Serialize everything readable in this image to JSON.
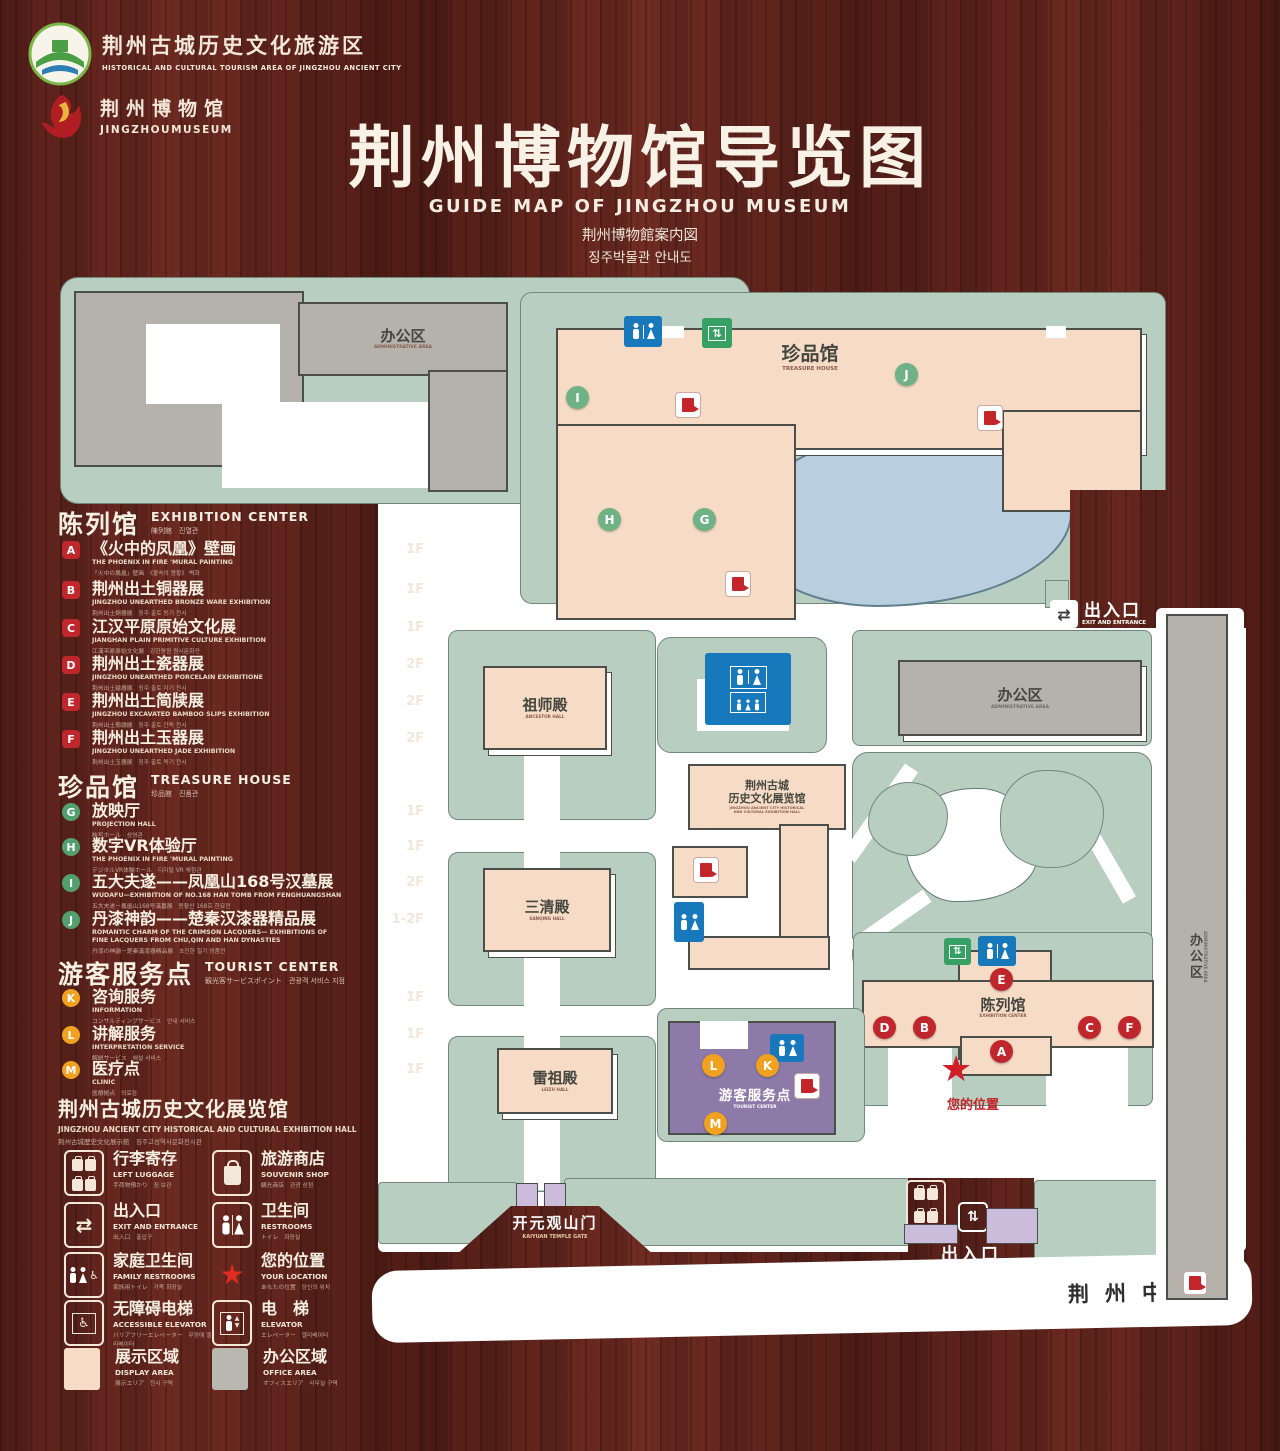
{
  "colors": {
    "wood": "#5b211a",
    "lawn": "#b7cec0",
    "building_gray": "#b4b2aa",
    "building_peach": "#f6dcc6",
    "pond": "#b9cede",
    "purple": "#8d7aa8",
    "purple_light": "#cbbcdc",
    "icon_blue": "#1878bc",
    "icon_green": "#36a065",
    "marker_red": "#c0272d",
    "marker_green": "#6fb286",
    "marker_yellow": "#f0a11f",
    "star_red": "#d01f26"
  },
  "header": {
    "logo_area": {
      "cn": "荆州古城历史文化旅游区",
      "en": "HISTORICAL AND CULTURAL TOURISM AREA OF JINGZHOU ANCIENT CITY"
    },
    "logo_museum": {
      "cn": "荆州博物馆",
      "en": "JINGZHOUMUSEUM"
    },
    "title": "荆州博物馆导览图",
    "subtitle_en": "GUIDE MAP OF JINGZHOU MUSEUM",
    "subtitle_ja": "荆州博物館案内図",
    "subtitle_ko": "징주박물관 안내도"
  },
  "legend": {
    "sections": [
      {
        "cn": "陈列馆",
        "en": "EXHIBITION CENTER",
        "sub": "陳列館　진열관",
        "items": [
          {
            "letter": "A",
            "cn": "《火中的凤凰》壁画",
            "en": "THE PHOENIX IN FIRE 'MURAL PAINTING",
            "sub": "「火中の鳳凰」壁画　《불속의 봉황》 벽화",
            "floor": "1F"
          },
          {
            "letter": "B",
            "cn": "荆州出土铜器展",
            "en": "JINGZHOU UNEARTHED BRONZE WARE EXHIBITION",
            "sub": "荆州出土銅器展　징주 출토 동기 전시",
            "floor": "1F"
          },
          {
            "letter": "C",
            "cn": "江汉平原原始文化展",
            "en": "JIANGHAN PLAIN PRIMITIVE CULTURE EXHIBITION",
            "sub": "江漢平原原始文化展　강한평원 원시문화전",
            "floor": "1F"
          },
          {
            "letter": "D",
            "cn": "荆州出土瓷器展",
            "en": "JINGZHOU UNEARTHED PORCELAIN EXHIBITIONE",
            "sub": "荆州出土磁器展　징주 출토 자기 전시",
            "floor": "2F"
          },
          {
            "letter": "E",
            "cn": "荆州出土简牍展",
            "en": "JINGZHOU EXCAVATED BAMBOO SLIPS EXHIBITION",
            "sub": "荆州出土簡牘展　징주 출토 간독 전시",
            "floor": "2F"
          },
          {
            "letter": "F",
            "cn": "荆州出土玉器展",
            "en": "JINGZHOU UNEARTHED JADE EXHIBITION",
            "sub": "荆州出土玉器展　징주 출토 옥기 전시",
            "floor": "2F"
          }
        ]
      },
      {
        "cn": "珍品馆",
        "en": "TREASURE HOUSE",
        "sub": "珍品館　진품관",
        "items": [
          {
            "letter": "G",
            "cn": "放映厅",
            "en": "PROJECTION HALL",
            "sub": "映写ホール　상영관",
            "floor": "1F"
          },
          {
            "letter": "H",
            "cn": "数字VR体验厅",
            "en": "THE PHOENIX IN FIRE 'MURAL PAINTING",
            "sub": "デジタルVR体験ホール　디지털 VR 체험관",
            "floor": "1F"
          },
          {
            "letter": "I",
            "cn": "五大夫遂——凤凰山168号汉墓展",
            "en": "WUDAFU—EXHIBITION OF NO.168 HAN TOMB FROM FENGHUANGSHAN",
            "sub": "五大夫遂－鳳凰山168号漢墓展　봉황산 168호 한묘전",
            "floor": "2F"
          },
          {
            "letter": "J",
            "cn": "丹漆神韵——楚秦汉漆器精品展",
            "en": "ROMANTIC CHARM OF THE CRIMSON LACQUERS— EXHIBITIONS OF FINE LACQUERS FROM CHU,QIN AND HAN DYNASTIES",
            "sub": "丹漆の神韻－楚秦漢漆器精品展　초진한 칠기 정품전",
            "floor": "1-2F"
          }
        ]
      },
      {
        "cn": "游客服务点",
        "en": "TOURIST CENTER",
        "sub": "観光客サービスポイント　관광객 서비스 지점",
        "items": [
          {
            "letter": "K",
            "cn": "咨询服务",
            "en": "INFORMATION",
            "sub": "コンサルティングサービス　안내 서비스",
            "floor": "1F"
          },
          {
            "letter": "L",
            "cn": "讲解服务",
            "en": "INTERPRETATION SERVICE",
            "sub": "解説サービス　해설 서비스",
            "floor": "1F"
          },
          {
            "letter": "M",
            "cn": "医疗点",
            "en": "CLINIC",
            "sub": "医療拠点　의료점",
            "floor": "1F"
          }
        ]
      }
    ],
    "hall": {
      "cn": "荆州古城历史文化展览馆",
      "en": "JINGZHOU ANCIENT CITY HISTORICAL AND CULTURAL EXHIBITION HALL",
      "sub": "荆州古城歴史文化展示館　징주고성역사문화전시관"
    },
    "icons": [
      {
        "cn": "行李寄存",
        "en": "LEFT LUGGAGE",
        "sub": "手荷物預かり　짐 보관"
      },
      {
        "cn": "旅游商店",
        "en": "SOUVENIR SHOP",
        "sub": "観光商店　관광 상점"
      },
      {
        "cn": "出入口",
        "en": "EXIT AND ENTRANCE",
        "sub": "出入口　출입구"
      },
      {
        "cn": "卫生间",
        "en": "RESTROOMS",
        "sub": "トイレ　화장실"
      },
      {
        "cn": "家庭卫生间",
        "en": "FAMILY RESTROOMS",
        "sub": "家族用トイレ　가족 화장실"
      },
      {
        "cn": "您的位置",
        "en": "YOUR LOCATION",
        "sub": "あなたの位置　당신의 위치"
      },
      {
        "cn": "无障碍电梯",
        "en": "ACCESSIBLE ELEVATOR",
        "sub": "バリアフリーエレベーター　무장애 엘리베이터"
      },
      {
        "cn": "电　梯",
        "en": "ELEVATOR",
        "sub": "エレベーター　엘리베이터"
      },
      {
        "cn": "展示区域",
        "en": "DISPLAY AREA",
        "sub": "展示エリア　전시 구역"
      },
      {
        "cn": "办公区域",
        "en": "OFFICE AREA",
        "sub": "オフィスエリア　사무실 구역"
      }
    ]
  },
  "map": {
    "admin_top": {
      "cn": "办公区",
      "en": "ADMINISTRATIVE AREA"
    },
    "treasure": {
      "cn": "珍品馆",
      "en": "TREASURE HOUSE"
    },
    "ancestor": {
      "cn": "祖师殿",
      "en": "ANCESTOR HALL"
    },
    "sanqing": {
      "cn": "三清殿",
      "en": "SANQING HALL"
    },
    "leizu": {
      "cn": "雷祖殿",
      "en": "LEIZU HALL"
    },
    "exhibition_hall": {
      "cn1": "荆州古城",
      "cn2": "历史文化展览馆",
      "en1": "JINGZHOU ANCIENT CITY HISTORICAL",
      "en2": "AND CULTURAL EXHIBITION HALL"
    },
    "admin_right": {
      "cn": "办公区",
      "en": "ADMINISTRATIVE AREA"
    },
    "admin_strip": {
      "cn": "办公区",
      "en": "ADMINISTRATIVE AREA"
    },
    "exhibition_center": {
      "cn": "陈列馆",
      "en": "EXHIBITION CENTER"
    },
    "tourist": {
      "cn": "游客服务点",
      "en": "TOURIST CENTER"
    },
    "your_location": "您的位置",
    "exit_top": {
      "cn": "出入口",
      "en": "EXIT AND ENTRANCE"
    },
    "exit_bottom": {
      "cn": "出入口",
      "en": "EXIT AND ENTRANCE"
    },
    "gate": {
      "cn": "开元观山门",
      "en": "KAIYUAN TEMPLE GATE"
    },
    "road": "荆州中路",
    "letters": {
      "a": "A",
      "b": "B",
      "c": "C",
      "d": "D",
      "e": "E",
      "f": "F",
      "g": "G",
      "h": "H",
      "i": "I",
      "j": "J",
      "k": "K",
      "l": "L",
      "m": "M"
    },
    "glyphs": {
      "arrows_lr": "⇄",
      "arrows_ud": "⇅",
      "star": "★",
      "wheelchair": "♿",
      "up": "▲",
      "down": "▼"
    }
  }
}
